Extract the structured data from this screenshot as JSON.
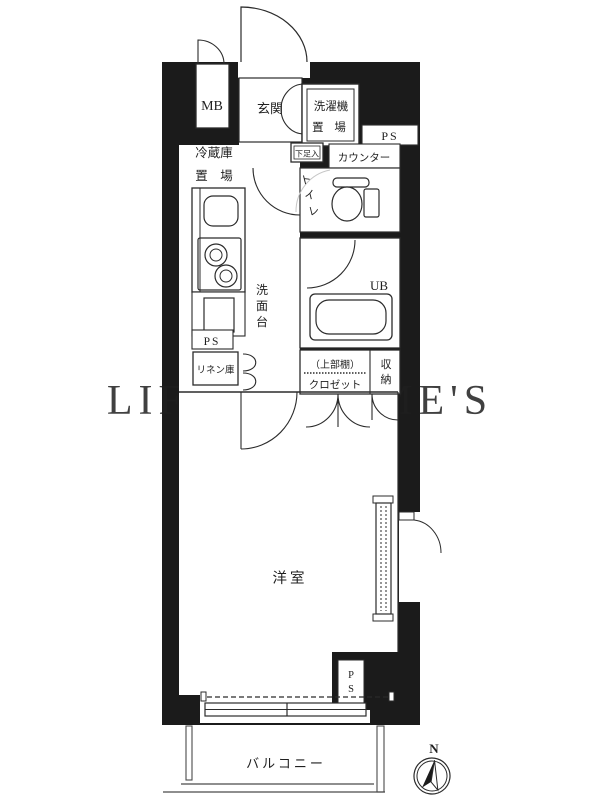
{
  "plan": {
    "labels": {
      "mb": "MB",
      "genkan": "玄関",
      "washer_line1": "洗濯機",
      "washer_line2": "置 場",
      "ps_top": "PS",
      "shoe_box": "下足入",
      "counter": "カウンター",
      "toilet_chars": [
        "ト",
        "イ",
        "レ"
      ],
      "fridge_line1": "冷蔵庫",
      "fridge_line2": "置　場",
      "washstand_chars": [
        "洗",
        "面",
        "台"
      ],
      "ps_left": "PS",
      "linen": "リネン庫",
      "ub": "UB",
      "upper_shelf": "（上部棚）",
      "closet": "クロゼット",
      "storage_chars": [
        "収",
        "納"
      ],
      "western_room": "洋室",
      "ps_bottom_chars": [
        "P",
        "S"
      ],
      "balcony": "バルコニー"
    },
    "compass": {
      "north": "N"
    },
    "watermark": "LIFULL HOME'S",
    "colors": {
      "wall": "#1b1b1b",
      "line": "#2b2b2b",
      "balcony_line": "#4a4a4a",
      "watermark": "#9b9b9b"
    }
  }
}
